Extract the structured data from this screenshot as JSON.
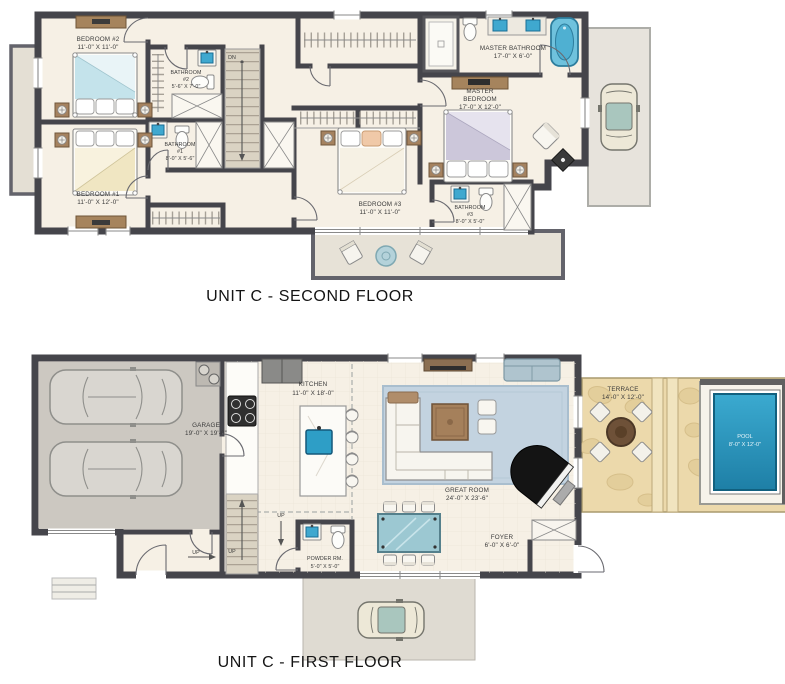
{
  "titles": {
    "second_floor": "UNIT C - SECOND FLOOR",
    "first_floor": "UNIT C - FIRST FLOOR"
  },
  "colors": {
    "wall": "#45454B",
    "floor": "#F6F0E5",
    "garage_floor": "#CCC8C1",
    "balcony": "#E7E2D7",
    "terrace": "#ECD9AB",
    "pool_water": "#2E9EC6",
    "rug": "#C3D3E0",
    "wood": "#A5805B",
    "fixture_blue": "#3FA8CF",
    "stair": "#DAD3C3"
  },
  "second_floor": {
    "stairs": {
      "label": "DN"
    },
    "bedroom2": {
      "lines": [
        "BEDROOM #2",
        "11'-0\" X 11'-0\""
      ]
    },
    "bedroom1": {
      "lines": [
        "BEDROOM #1",
        "11'-0\" X 12'-0\""
      ]
    },
    "bedroom3": {
      "lines": [
        "BEDROOM #3",
        "11'-0\" X 11'-0\""
      ]
    },
    "bathroom2": {
      "lines": [
        "BATHROOM",
        "#2",
        "5'-6\" X 7'-0\""
      ]
    },
    "bathroom1": {
      "lines": [
        "BATHROOM",
        "#1",
        "8'-0\" X 5'-6\""
      ]
    },
    "bathroom3": {
      "lines": [
        "BATHROOM",
        "#3",
        "8'-0\" X 5'-0\""
      ]
    },
    "master_bathroom": {
      "lines": [
        "MASTER BATHROOM",
        "17'-0\" X 6'-0\""
      ]
    },
    "master_bedroom": {
      "lines": [
        "MASTER",
        "BEDROOM",
        "17'-0\" X 12'-0\""
      ]
    }
  },
  "first_floor": {
    "stairs": {
      "up1": "UP",
      "up2": "UP",
      "up3": "UP"
    },
    "garage": {
      "lines": [
        "GARAGE",
        "19'-0\" X 19'-0\""
      ]
    },
    "kitchen": {
      "lines": [
        "KITCHEN",
        "11'-0\" X 18'-0\""
      ]
    },
    "great_room": {
      "lines": [
        "GREAT ROOM",
        "24'-0\" X 23'-6\""
      ]
    },
    "powder_room": {
      "lines": [
        "POWDER RM.",
        "5'-0\" X 5'-0\""
      ]
    },
    "foyer": {
      "lines": [
        "FOYER",
        "6'-0\" X 6'-0\""
      ]
    },
    "terrace": {
      "lines": [
        "TERRACE",
        "14'-0\" X 12'-0\""
      ]
    },
    "pool": {
      "lines": [
        "POOL",
        "8'-0\" X 12'-0\""
      ]
    }
  }
}
